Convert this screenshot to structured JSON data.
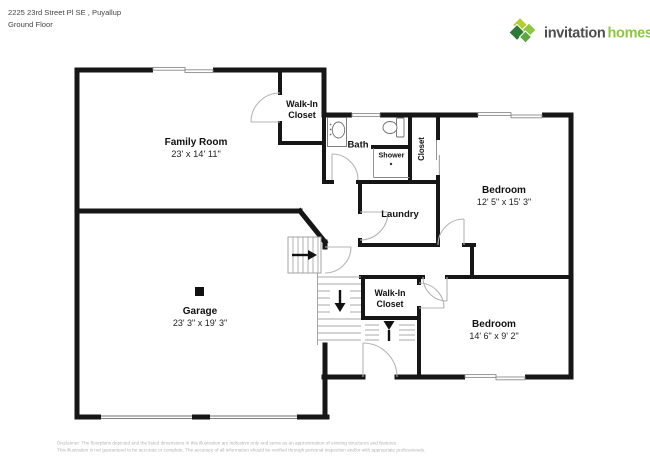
{
  "header": {
    "address_line1": "2225 23rd Street Pl SE , Puyallup",
    "address_line2": "Ground Floor"
  },
  "logo": {
    "brand_word1": "invitation",
    "brand_word2": "homes",
    "color_word1": "#4d4d4f",
    "color_word2": "#8dc63f",
    "icon_colors": [
      "#b6cc35",
      "#8dc63f",
      "#2d7a36",
      "#5ba63f"
    ]
  },
  "floor_plan": {
    "wall_color": "#161616",
    "rooms": {
      "family_room": {
        "name": "Family Room",
        "dims": "23' x 14' 11\""
      },
      "walk_in_closet_top": {
        "line1": "Walk-In",
        "line2": "Closet"
      },
      "bath": {
        "name": "Bath"
      },
      "shower": {
        "name": "Shower"
      },
      "closet": {
        "name": "Closet"
      },
      "laundry": {
        "name": "Laundry"
      },
      "bedroom_right": {
        "name": "Bedroom",
        "dims": "12' 5\" x 15' 3\""
      },
      "garage": {
        "name": "Garage",
        "dims": "23' 3\" x 19' 3\""
      },
      "walk_in_closet_mid": {
        "line1": "Walk-In",
        "line2": "Closet"
      },
      "bedroom_bottom": {
        "name": "Bedroom",
        "dims": "14' 6\" x 9' 2\""
      }
    }
  },
  "footer": {
    "disclaimer_line1": "Disclaimer: The floorplans depicted and the listed dimensions in this illustration are indicative only and serve as an approximation of existing structures and features.",
    "disclaimer_line2": "This illustration is not guaranteed to be accurate or complete. The accuracy of all information should be verified through personal inspection and/or with appropriate professionals."
  }
}
